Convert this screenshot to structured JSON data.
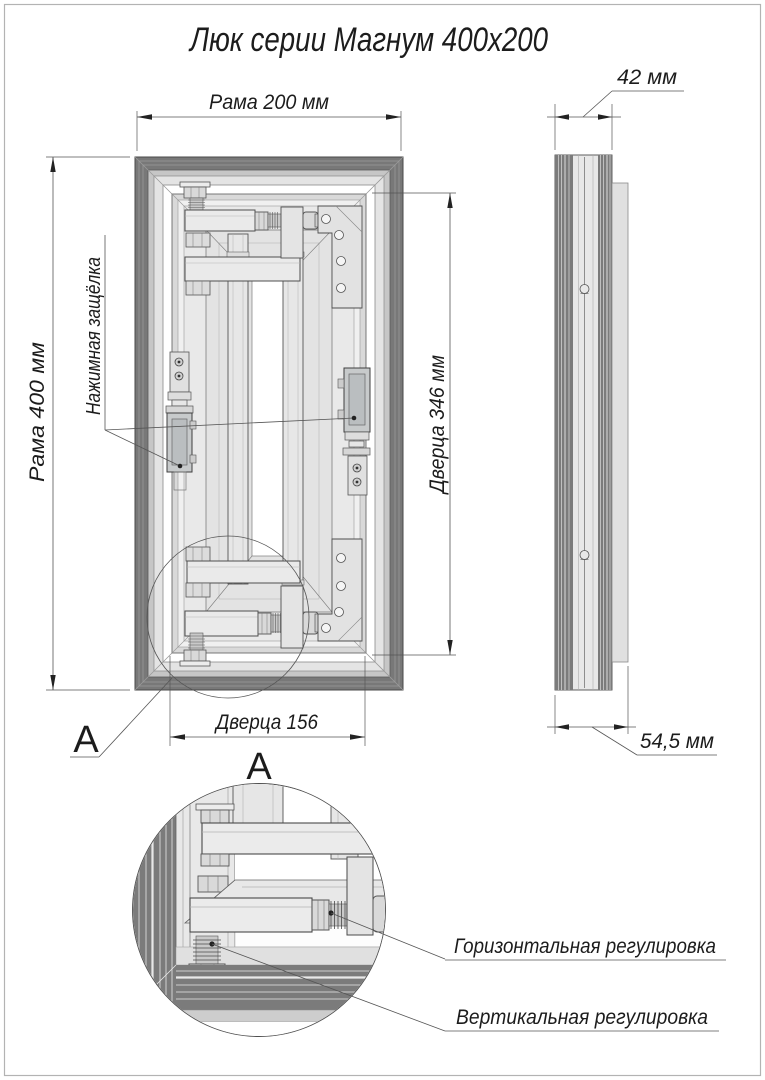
{
  "title": "Люк серии Магнум 400x200",
  "front_view": {
    "dim_frame_width": "Рама 200 мм",
    "dim_frame_height": "Рама 400 мм",
    "dim_door_height": "Дверца 346 мм",
    "dim_door_width": "Дверца 156",
    "latch_label": "Нажимная защёлка",
    "detail_letter": "A"
  },
  "side_view": {
    "dim_depth_top": "42 мм",
    "dim_depth_bottom": "54,5 мм"
  },
  "detail_view": {
    "title": "A",
    "label_horizontal": "Горизонтальная регулировка",
    "label_vertical": "Вертикальная регулировка"
  },
  "colors": {
    "line": "#3f3f3f",
    "dim_line": "#555555",
    "frame_dark": "#787878",
    "frame_mid": "#c6c6c6",
    "frame_light": "#e4e4e4",
    "door_leaf": "#e9e9e9",
    "metal_part": "#eaeaea",
    "latch_body": "#c7cacb",
    "background": "#ffffff"
  }
}
